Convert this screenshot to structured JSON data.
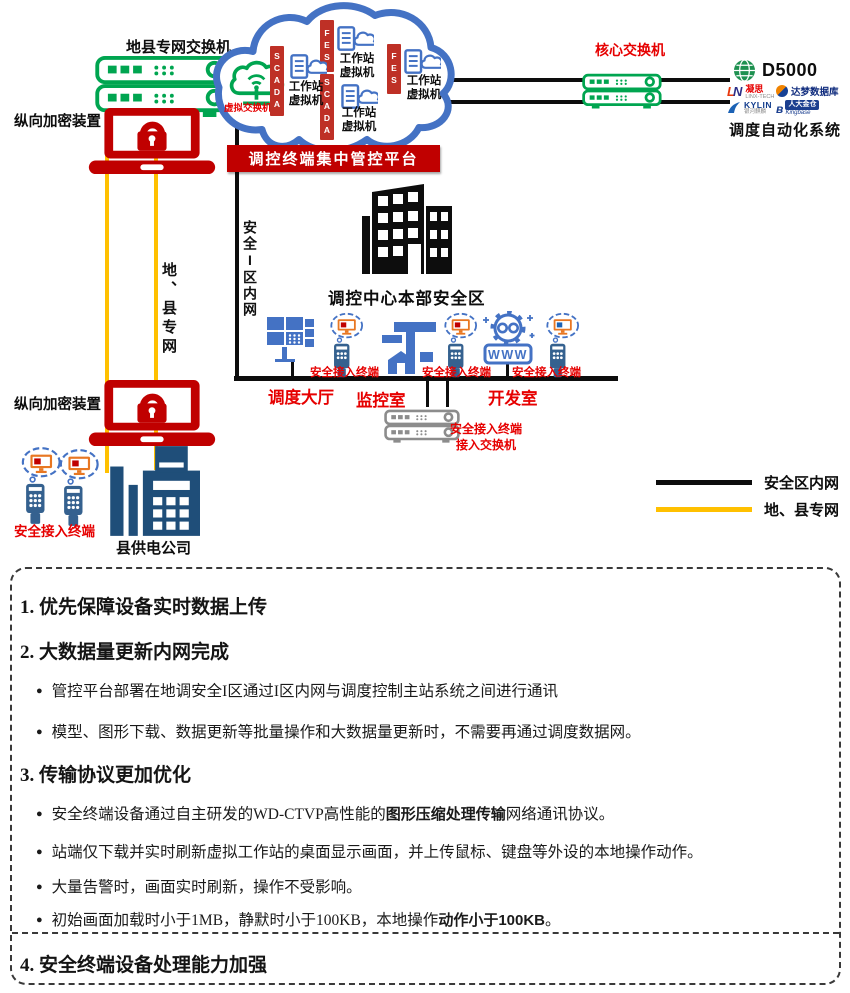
{
  "diagram": {
    "colors": {
      "red_accent": "#C00000",
      "bright_red_text": "#E60000",
      "cloud_blue": "#4472C4",
      "green": "#00A550",
      "yellow_net": "#FFC000",
      "navy": "#1F4E79"
    },
    "top_left": {
      "switch_label": "地县专网交换机",
      "encryptor_label": "纵向加密装置",
      "vertical_net_label": "地、县专网",
      "terminal_label": "安全接入终端",
      "company_label": "县供电公司"
    },
    "cloud": {
      "virtual_switch_label": "虚拟交换机",
      "bars": [
        "SCADA",
        "FES",
        "SCADA",
        "FES"
      ],
      "vm_label": "工作站虚拟机",
      "banner": "调控终端集中管控平台"
    },
    "center": {
      "zone_line_label": "安全I区内网",
      "building_label": "调控中心本部安全区",
      "dispatch_hall_label": "调度大厅",
      "monitor_room_label": "监控室",
      "dev_room_label": "开发室",
      "www_text": "WWW",
      "terminal_label": "安全接入终端",
      "access_switch_label_line1": "安全接入终端",
      "access_switch_label_line2": "接入交换机"
    },
    "right": {
      "core_switch_label": "核心交换机",
      "d5000": "D5000",
      "linx": "凝思",
      "linx_sub": "LINX-TECH",
      "dm": "达梦数据库",
      "kylin": "KYLIN",
      "kylin_sub": "银河麒麟",
      "kingbase": "人大金仓",
      "kingbase_sub": "Kingbase",
      "system_label": "调度自动化系统"
    },
    "legend": {
      "intranet_label": "安全区内网",
      "private_net_label": "地、县专网"
    }
  },
  "panel": {
    "bullet_glyph": "●",
    "sections": [
      {
        "heading": "1. 优先保障设备实时数据上传",
        "bullets": []
      },
      {
        "heading": "2. 大数据量更新内网完成",
        "bullets": [
          {
            "pre": "管控平台部署在地调安全I区通过I区内网与调度控制主站系统之间进行通讯",
            "bold": "",
            "post": ""
          },
          {
            "pre": "模型、图形下载、数据更新等批量操作和大数据量更新时，不需要再通过调度数据网。",
            "bold": "",
            "post": ""
          }
        ]
      },
      {
        "heading": "3. 传输协议更加优化",
        "bullets": [
          {
            "pre": "安全终端设备通过自主研发的WD-CTVP高性能的",
            "bold": "图形压缩处理传输",
            "post": "网络通讯协议。"
          },
          {
            "pre": "站端仅下载并实时刷新虚拟工作站的桌面显示画面，并上传鼠标、键盘等外设的本地操作动作。",
            "bold": "",
            "post": ""
          },
          {
            "pre": "大量告警时，画面实时刷新，操作不受影响。",
            "bold": "",
            "post": ""
          },
          {
            "pre": "初始画面加载时小于1MB，静默时小于100KB，本地操作",
            "bold": "动作小于100KB",
            "post": "。"
          }
        ]
      },
      {
        "heading": "4. 安全终端设备处理能力加强",
        "bullets": []
      }
    ]
  }
}
